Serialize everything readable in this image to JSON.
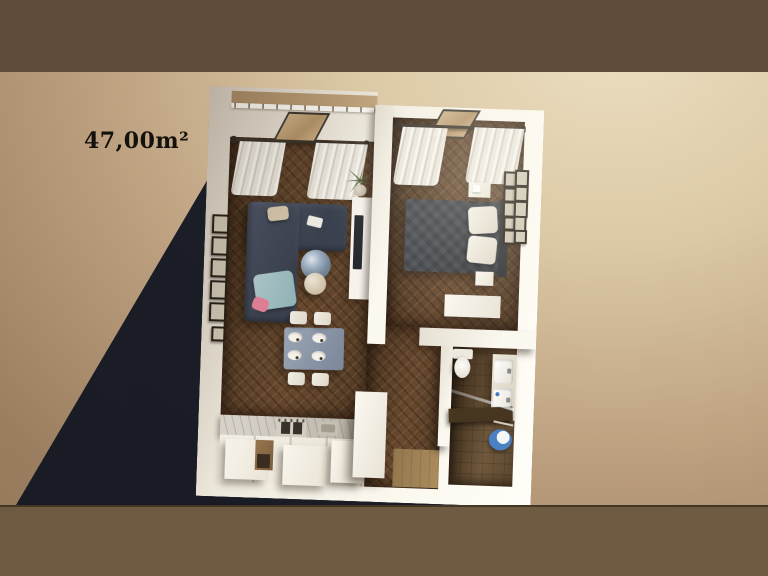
{
  "scene": {
    "type": "3d-floor-plan-render",
    "area_label": "47,00m²"
  },
  "palette": {
    "background_left": "#9a7e5f",
    "background_right": "#ecdfc2",
    "top_bar": "#604d39",
    "bottom_bar": "#6f5b42",
    "cast_shadow": "#141823",
    "walls": "#faf6ec",
    "wood_floor": "#5e4731",
    "bathroom_floor": "#65503a",
    "sofa": "#414a5b",
    "bed": "#3b3f46",
    "dining_table": "#8b97a8",
    "coffee_table_marble": "#8ea1b5",
    "bath_rug_blue": "#4a80c4",
    "curtains": "#efece3",
    "blanket_blue": "#a3c2c5",
    "pillow_pink": "#e5829b",
    "balcony_floor": "#b99c73"
  },
  "rooms": [
    {
      "id": "living-room",
      "furniture": [
        "sectional-sofa",
        "coffee-table",
        "side-table",
        "tv-cabinet",
        "plant",
        "wall-frames",
        "curtains",
        "window",
        "balcony-railing"
      ]
    },
    {
      "id": "bedroom",
      "furniture": [
        "double-bed",
        "pillows",
        "headboard",
        "nightstand-top",
        "nightstand-bottom",
        "dresser",
        "gallery-frames",
        "curtains",
        "window"
      ]
    },
    {
      "id": "dining-area",
      "furniture": [
        "dining-table",
        "plates",
        "chairs"
      ]
    },
    {
      "id": "kitchen",
      "furniture": [
        "counter",
        "stove",
        "sink",
        "cabinets",
        "tall-cabinet"
      ]
    },
    {
      "id": "hallway",
      "furniture": [
        "entry-mat"
      ]
    },
    {
      "id": "bathroom",
      "furniture": [
        "toilet",
        "double-sink-vanity",
        "shower-screen",
        "bench",
        "blue-rug",
        "towel-bar"
      ]
    }
  ]
}
